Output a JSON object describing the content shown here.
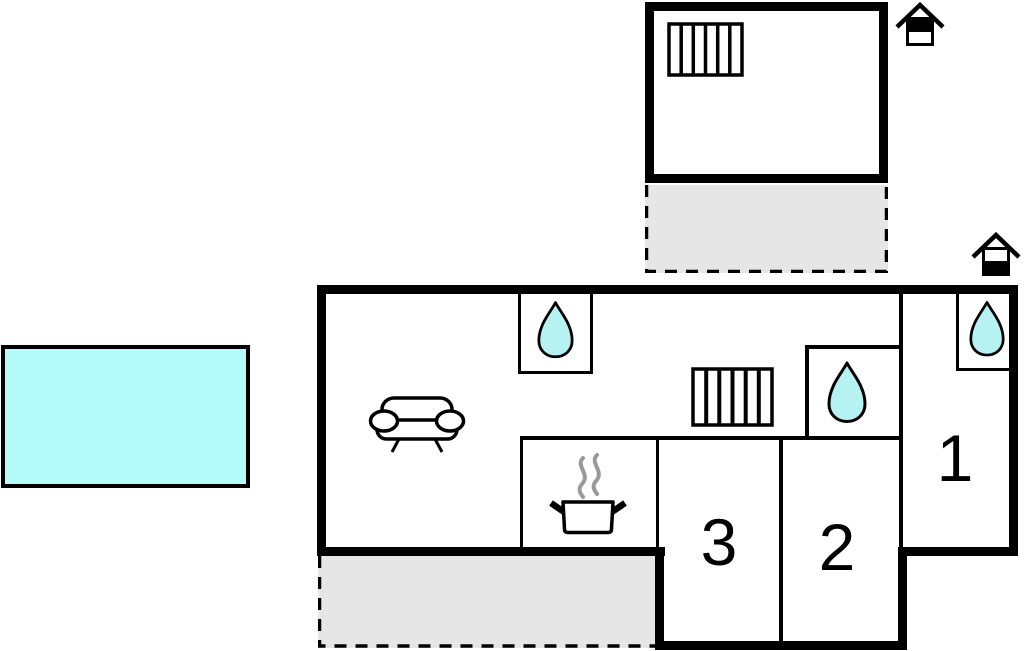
{
  "floorplan": {
    "rooms": {
      "bedroom1": {
        "label": "1"
      },
      "bedroom2": {
        "label": "2"
      },
      "bedroom3": {
        "label": "3"
      }
    },
    "colors": {
      "wall": "#000000",
      "water": "#b5f2f1",
      "pool": "#b4fbfa",
      "terrace": "#e6e6e6",
      "steam": "#999999",
      "background": "#ffffff"
    },
    "icons": [
      "swimming-pool",
      "terrace-annex",
      "terrace-main",
      "house-marker-annex-icon",
      "house-marker-main-icon",
      "radiator-annex-icon",
      "radiator-main-icon",
      "water-drop-shower-room-icon",
      "water-drop-bathroom-icon",
      "water-drop-bedroom1-icon",
      "sofa-icon",
      "cooking-pot-icon"
    ]
  }
}
